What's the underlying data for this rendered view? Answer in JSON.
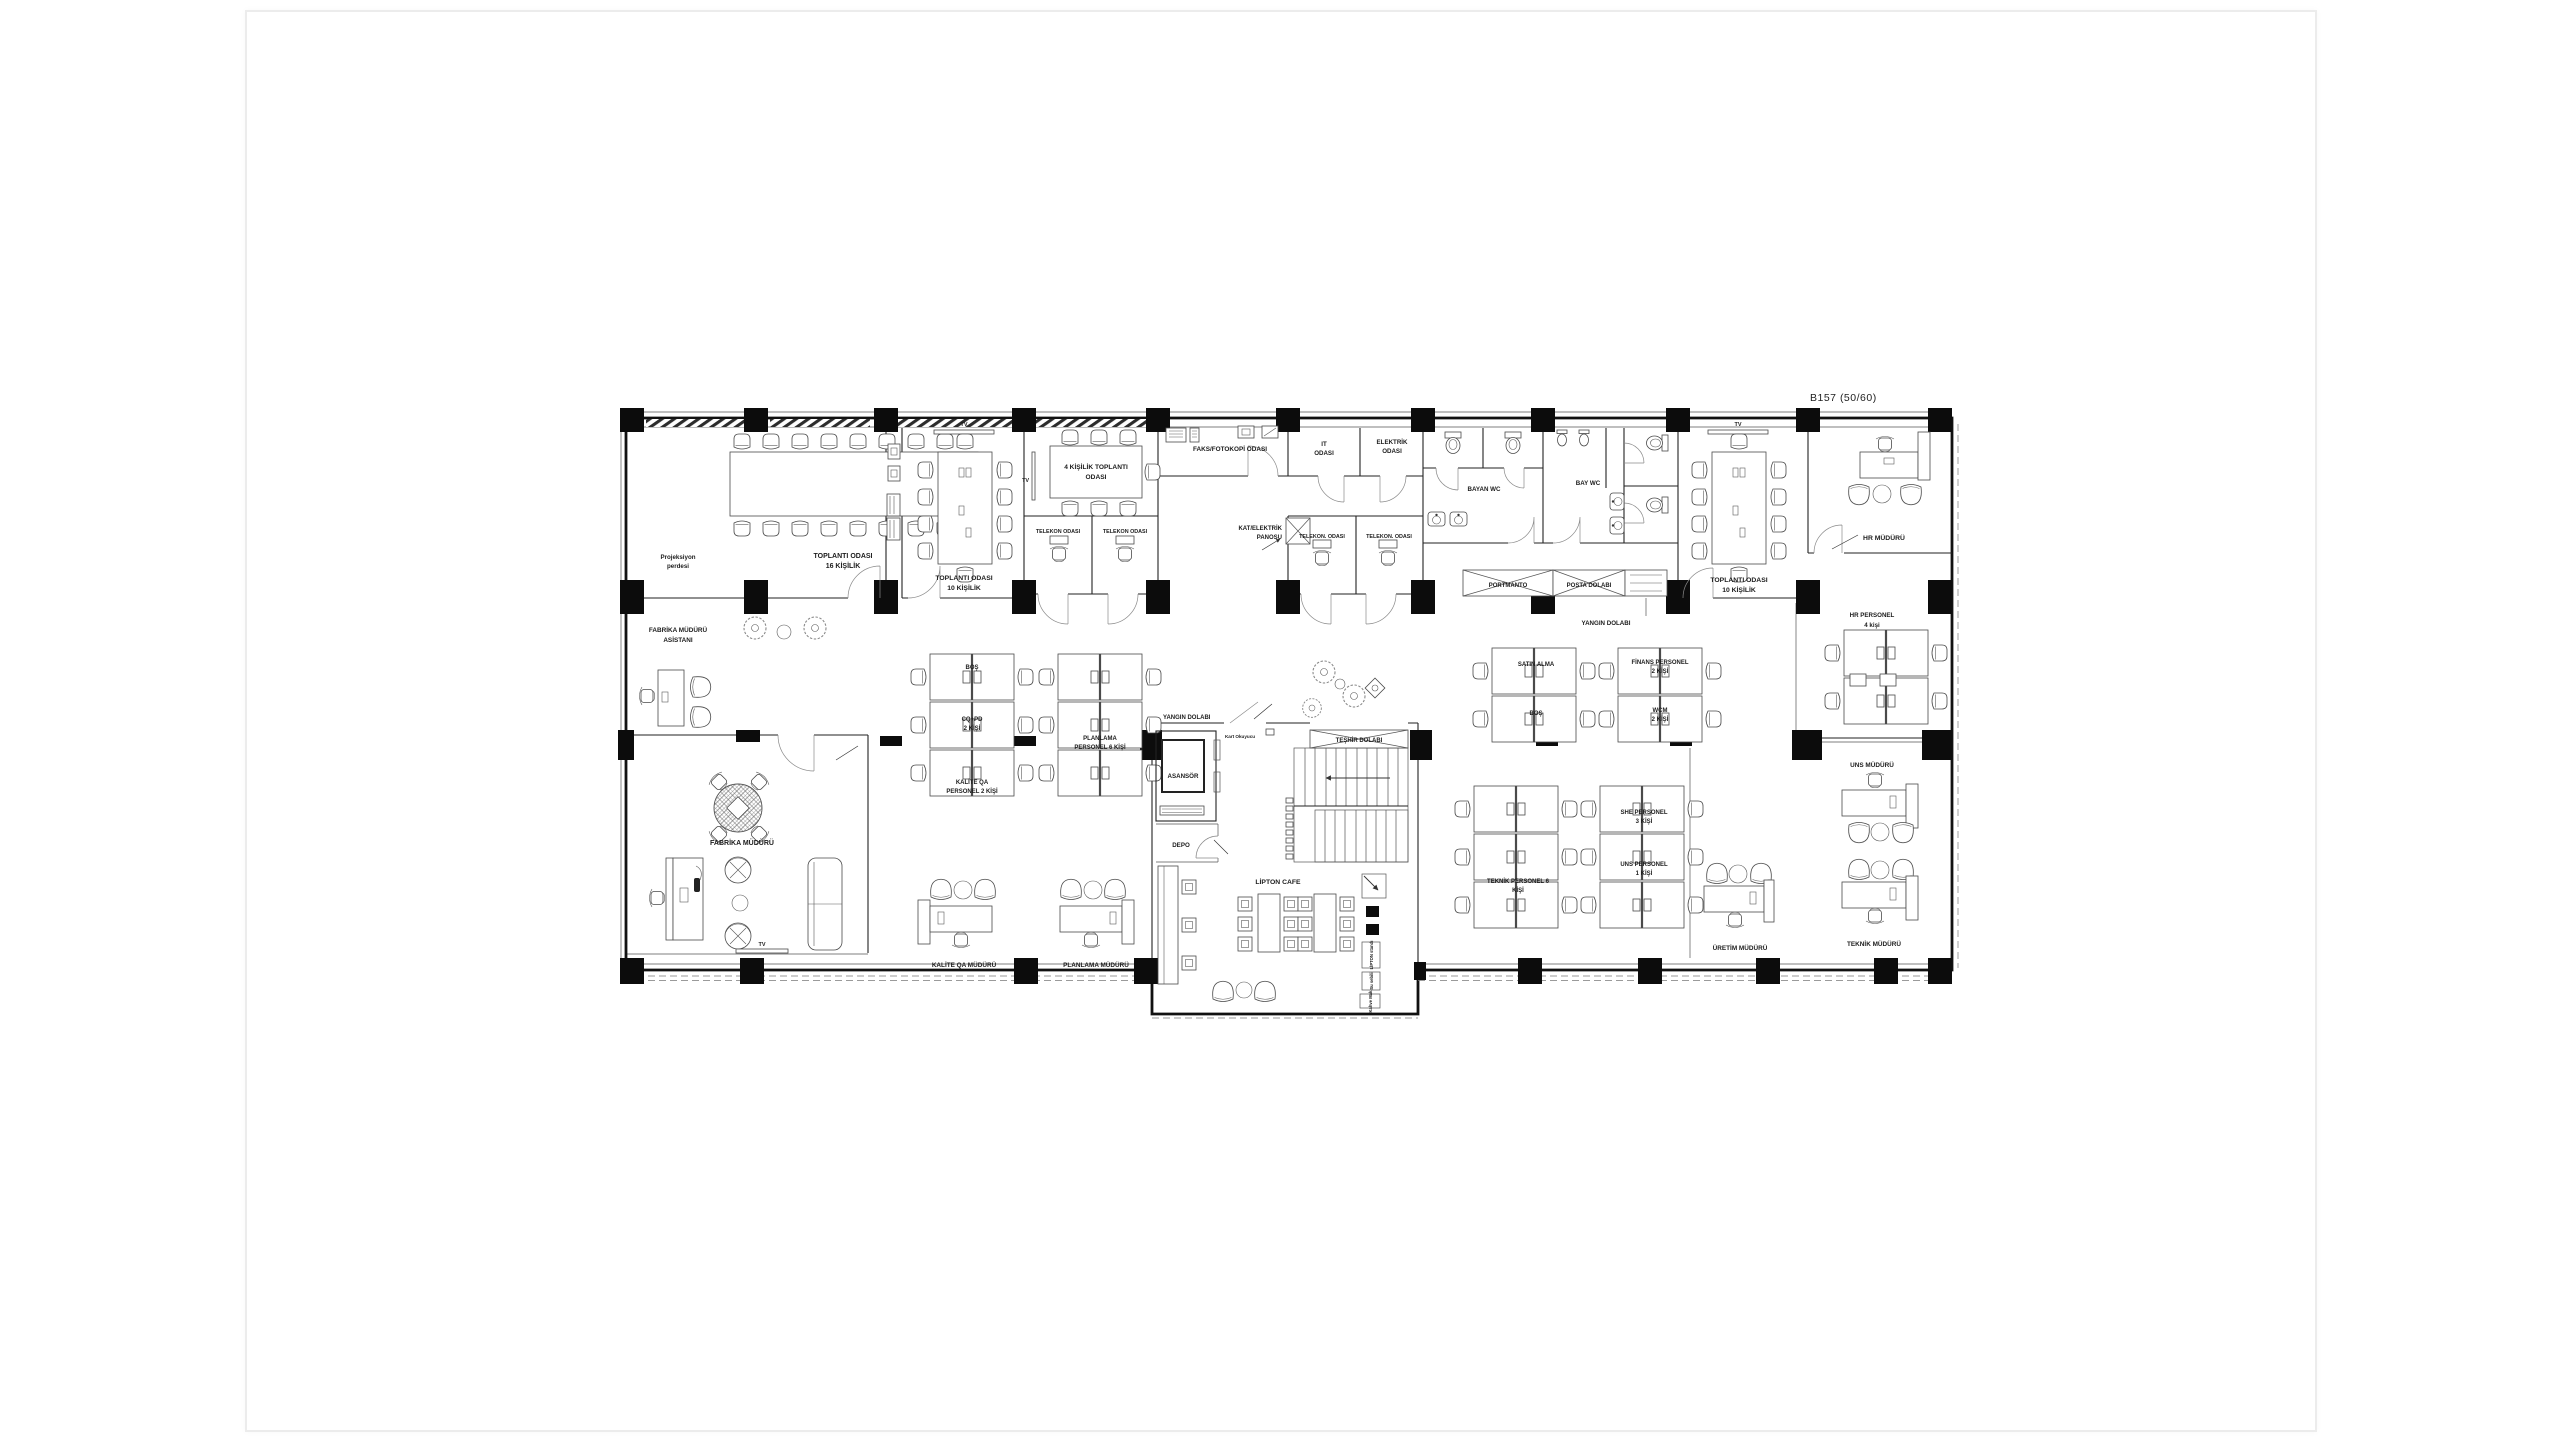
{
  "colors": {
    "ink": "#1c1c1c",
    "wall": "#0c0c0c",
    "sheet_border": "#ececec"
  },
  "plan": {
    "title": "B157 (50/60)",
    "projeksiyon1": "Projeksiyon",
    "projeksiyon2": "perdesi",
    "m16a": "TOPLANTI ODASI",
    "m16b": "16 KİŞİLİK",
    "m10la": "TOPLANTI ODASI",
    "m10lb": "10 KİŞİLİK",
    "m10ltv": "TV",
    "m4a": "4 KİŞİLİK TOPLANTI",
    "m4b": "ODASI",
    "m4tv": "TV",
    "tele1": "TELEKON ODASI",
    "tele2": "TELEKON ODASI",
    "tele3": "TELEKON. ODASI",
    "tele4": "TELEKON. ODASI",
    "faks": "FAKS/FOTOKOPİ ODASI",
    "ita": "IT",
    "itb": "ODASI",
    "eleka": "ELEKTRİK",
    "elekb": "ODASI",
    "panoa": "KAT/ELEKTRİK",
    "panob": "PANOSU",
    "bayanwc": "BAYAN WC",
    "baywc": "BAY WC",
    "portmanto": "PORTMANTO",
    "posta": "POSTA DOLABI",
    "yangin1": "YANGIN DOLABI",
    "m10ra": "TOPLANTI ODASI",
    "m10rb": "10 KİŞİLİK",
    "m10rtv": "TV",
    "hrm": "HR MÜDÜRÜ",
    "fasist1": "FABRİKA MÜDÜRÜ",
    "fasist2": "ASİSTANI",
    "fmudur": "FABRİKA MÜDÜRÜ",
    "ftv": "TV",
    "yangin2": "YANGIN DOLABI",
    "kart": "Kart Okuyucu",
    "teshir": "TEŞHİR DOLABI",
    "asansor": "ASANSÖR",
    "depo": "DEPO",
    "cafe": "LİPTON CAFE",
    "cafebox1": "LİPTON standı",
    "cafebox2": "Su sebili",
    "cafebox3": "Kahve Mak.",
    "bos1": "BOŞ",
    "cqpda": "CQ+PD",
    "cqpdb": "2 KİŞİ",
    "kqpa": "KALİTE QA",
    "kqpb": "PERSONEL 2 KİŞİ",
    "plpa": "PLANLAMA",
    "plpb": "PERSONEL 6 KİŞİ",
    "kqm": "KALİTE QA MÜDÜRÜ",
    "plm": "PLANLAMA MÜDÜRÜ",
    "satin": "SATIN ALMA",
    "bos2": "BOŞ",
    "fina": "FİNANS PERSONEL",
    "finb": "2 KİŞİ",
    "wcma": "WCM",
    "wcmb": "2 KİŞİ",
    "tekpa": "TEKNİK PERSONEL 6",
    "tekpb": "KİŞİ",
    "shea": "SHE PERSONEL",
    "sheb": "3 KİŞİ",
    "unspa": "UNS PERSONEL",
    "unspb": "1 KİŞİ",
    "uretim": "ÜRETİM MÜDÜRÜ",
    "hrpa": "HR PERSONEL",
    "hrpb": "4 kişi",
    "unsm": "UNS MÜDÜRÜ",
    "tekm": "TEKNİK MÜDÜRÜ"
  }
}
